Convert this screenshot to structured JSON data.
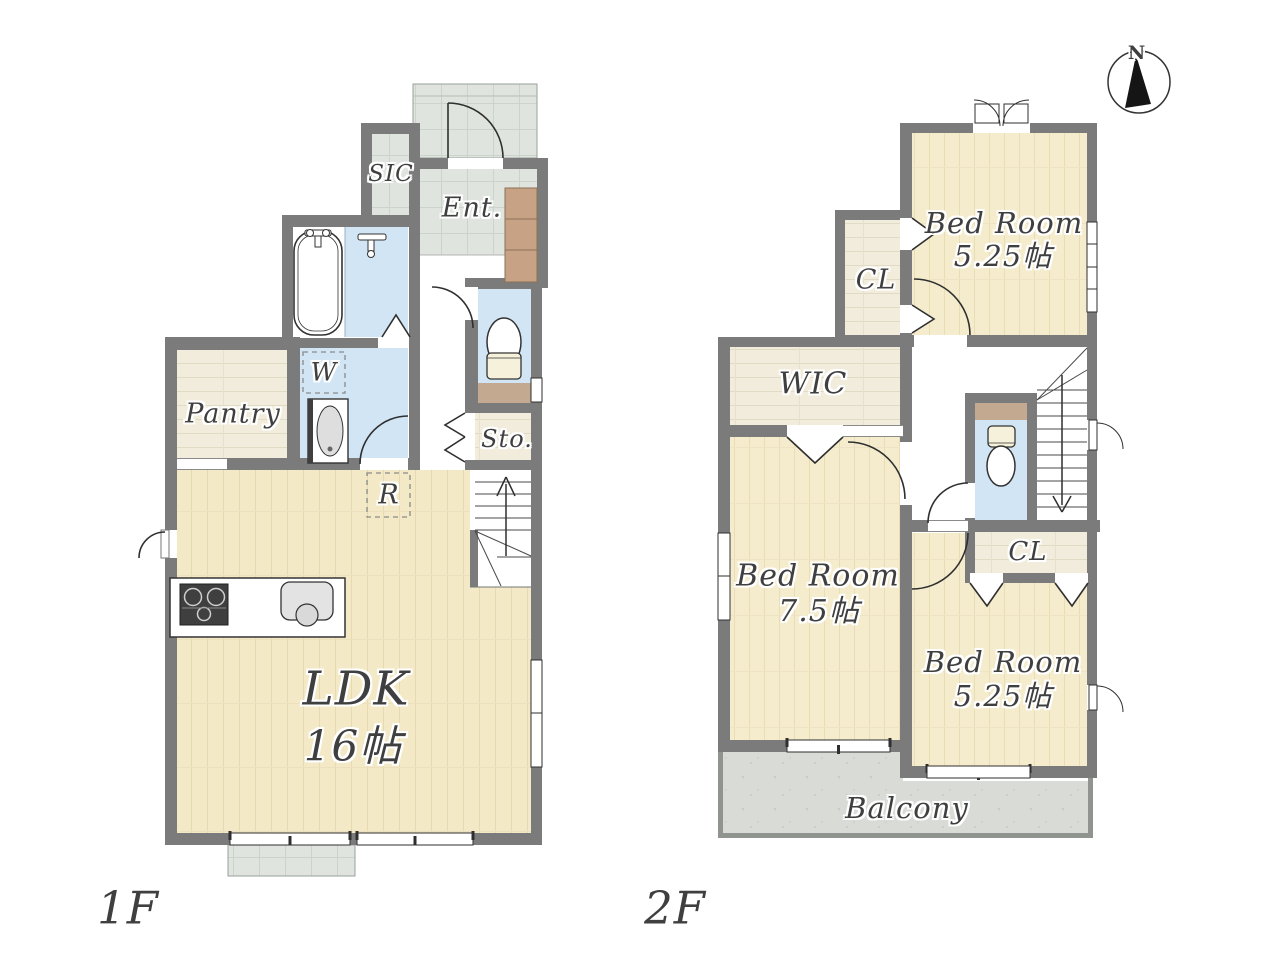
{
  "compass": {
    "north_label": "N"
  },
  "floor1": {
    "floor_label": "1F",
    "rooms": {
      "ldk_name": "LDK",
      "ldk_size": "16帖",
      "pantry": "Pantry",
      "sic": "SIC",
      "entrance": "Ent.",
      "storage": "Sto.",
      "washer_mark": "W",
      "fridge_mark": "R"
    }
  },
  "floor2": {
    "floor_label": "2F",
    "rooms": {
      "bedroom_north_name": "Bed Room",
      "bedroom_north_size": "5.25帖",
      "bedroom_west_name": "Bed Room",
      "bedroom_west_size": "7.5帖",
      "bedroom_south_name": "Bed Room",
      "bedroom_south_size": "5.25帖",
      "wic": "WIC",
      "closet_north": "CL",
      "closet_south": "CL",
      "balcony": "Balcony"
    }
  },
  "colors": {
    "wall": "#7b7b7b",
    "wood_floor": "#f3e9c6",
    "bedroom_floor": "#f5ecce",
    "light_wood": "#f1ecdb",
    "tile": "#dfe4df",
    "water_blue": "#d2e5f4",
    "shelf_brown": "#c7a285",
    "counter_brown": "#c2a98f",
    "balcony_gray": "#d8dbd6",
    "line": "#2f2f2f",
    "text": "#3f3f3f"
  }
}
